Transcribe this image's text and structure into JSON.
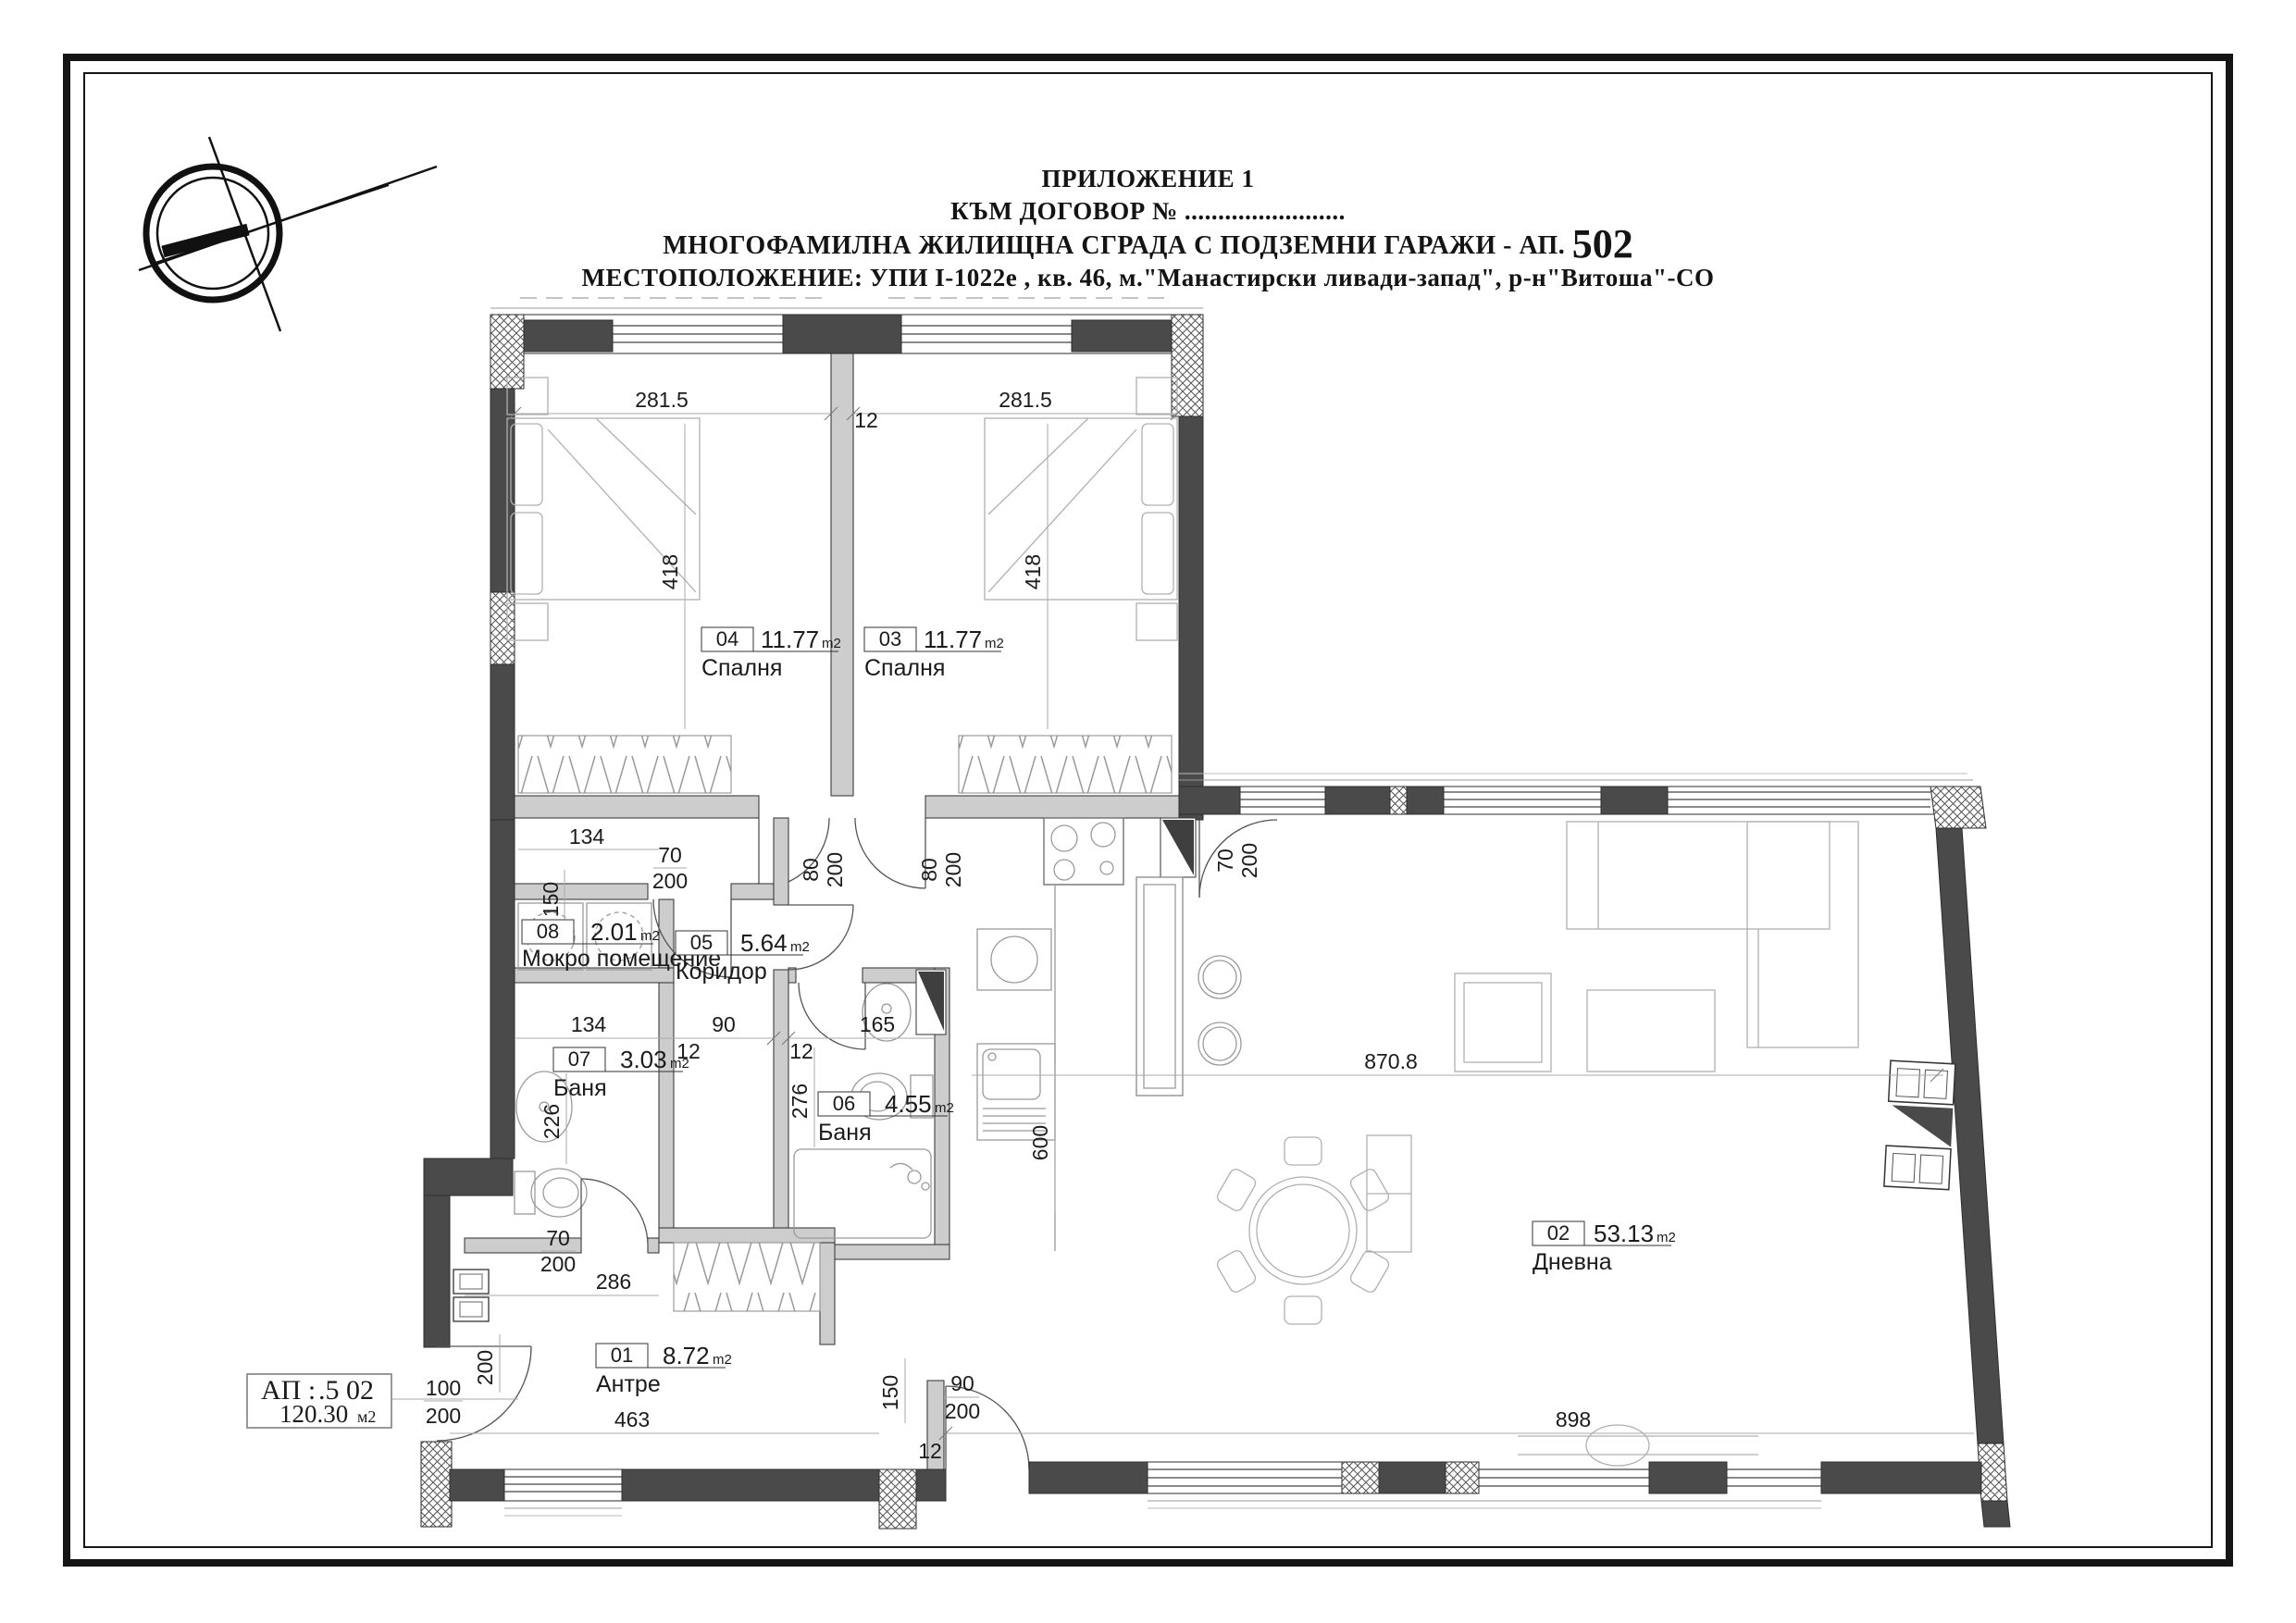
{
  "header": {
    "line1": "ПРИЛОЖЕНИЕ 1",
    "line2": "КЪМ ДОГОВОР № ........................",
    "line3_prefix": "МНОГОФАМИЛНА ЖИЛИЩНА СГРАДА С ПОДЗЕМНИ ГАРАЖИ - АП.",
    "line3_number": "502",
    "line4": "МЕСТОПОЛОЖЕНИЕ: УПИ I-1022е , кв. 46, м.\"Манастирски ливади-запад\", р-н\"Витоша\"-СО"
  },
  "title_block": {
    "ap_label": "АП :",
    "ap_number": ".5 02",
    "area_value": "120.30",
    "area_unit": "м2"
  },
  "unit": "m2",
  "rooms": [
    {
      "num": "01",
      "area": "8.72",
      "name": "Антре"
    },
    {
      "num": "02",
      "area": "53.13",
      "name": "Дневна"
    },
    {
      "num": "03",
      "area": "11.77",
      "name": "Спалня"
    },
    {
      "num": "04",
      "area": "11.77",
      "name": "Спалня"
    },
    {
      "num": "05",
      "area": "5.64",
      "name": "Коридор"
    },
    {
      "num": "06",
      "area": "4.55",
      "name": "Баня"
    },
    {
      "num": "07",
      "area": "3.03",
      "name": "Баня"
    },
    {
      "num": "08",
      "area": "2.01",
      "name": "Мокро помещение"
    }
  ],
  "dims": {
    "bed4_width": "281.5",
    "partition": "12",
    "bed3_width": "281.5",
    "bed4_depth": "418",
    "bed3_depth": "418",
    "door_w_80a": "80",
    "door_h_200a": "200",
    "door_w_80b": "80",
    "door_h_200b": "200",
    "lobby_134": "134",
    "wet_door_w": "70",
    "wet_door_h": "200",
    "lobby_150": "150",
    "bath7_134": "134",
    "wall_12a": "12",
    "corridor_90": "90",
    "wall_12b": "12",
    "bath6_165": "165",
    "bath6_276": "276",
    "bath7_226": "226",
    "bath7_door_w": "70",
    "bath7_door_h": "200",
    "bath7_286": "286",
    "antre_200": "200",
    "entry_door_w": "100",
    "entry_door_h": "200",
    "antre_463": "463",
    "antre_150": "150",
    "living_door_w": "90",
    "living_door_h": "200",
    "stub_12": "12",
    "kitchen_600": "600",
    "living_870": "870.8",
    "living_898": "898",
    "kitchen_door_w": "70",
    "kitchen_door_h": "200"
  },
  "colors": {
    "wall": "#4a4a4a",
    "partition": "#cdcdcd",
    "frame": "#151515"
  }
}
